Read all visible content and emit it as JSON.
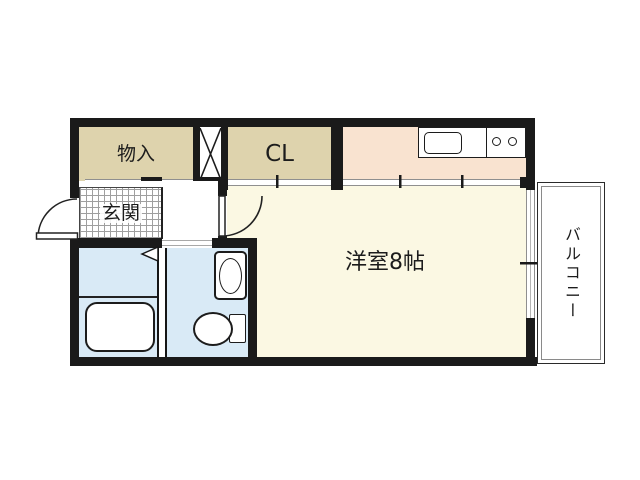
{
  "plan": {
    "type": "apartment-floor-plan",
    "rooms": {
      "storage": {
        "label": "物入"
      },
      "closet": {
        "label": "CL"
      },
      "entrance": {
        "label": "玄関"
      },
      "western_room": {
        "label": "洋室8帖"
      },
      "balcony": {
        "label": "バルコニー"
      }
    },
    "fixtures": [
      "kitchen-counter",
      "kitchen-sink",
      "stove-burner",
      "stove-burner",
      "bathtub",
      "washbasin",
      "toilet",
      "pipe-shaft",
      "entrance-swing-door",
      "room-swing-door",
      "folding-door",
      "sliding-door",
      "balcony-window"
    ],
    "colors": {
      "wall": "#1a1a1a",
      "storage_fill": "#ded3ad",
      "kitchen_fill": "#f9e3d0",
      "main_room_fill": "#fbf8e3",
      "wet_area_fill": "#d9eaf6",
      "balcony_fill": "#ffffff",
      "door_track": "#8f8f8f",
      "background": "#ffffff"
    }
  }
}
